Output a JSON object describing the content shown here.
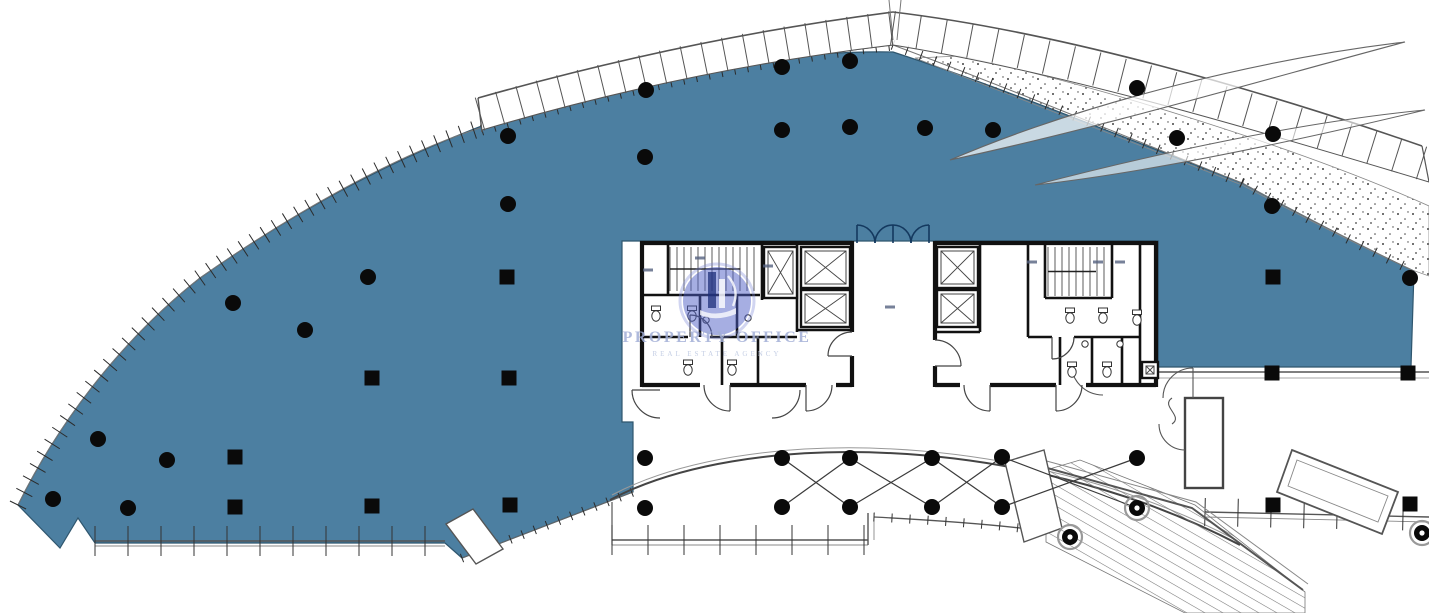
{
  "page": {
    "type": "architectural-floor-plan",
    "background": "#ffffff"
  },
  "watermark": {
    "title": "PROPERTY OFFICE",
    "subtitle": "REAL ESTATE AGENCY",
    "title_color": "#a2aed6",
    "subtitle_color": "#b6c2de",
    "emblem_color": "rgba(78,94,198,0.50)",
    "emblem_ring_color": "rgba(122,136,214,0.35)",
    "emblem_icon": "building-towers-icon"
  },
  "colors": {
    "floor": "#4C7FA1",
    "floor_edge": "#2f566e",
    "wall": "#111111",
    "line": "#555555",
    "tick": "#2b2b2b",
    "band_tick": "#555555",
    "door": "#444444",
    "entry_door": "#14395f",
    "column": "#0a0a0a",
    "stipple": "#444444"
  },
  "plan": {
    "columns": {
      "round": [
        [
          98,
          439
        ],
        [
          53,
          499
        ],
        [
          128,
          508
        ],
        [
          167,
          460
        ],
        [
          233,
          303
        ],
        [
          305,
          330
        ],
        [
          368,
          277
        ],
        [
          508,
          136
        ],
        [
          508,
          204
        ],
        [
          646,
          90
        ],
        [
          645,
          157
        ],
        [
          782,
          67
        ],
        [
          850,
          61
        ],
        [
          782,
          130
        ],
        [
          850,
          127
        ],
        [
          925,
          128
        ],
        [
          993,
          130
        ],
        [
          1137,
          88
        ],
        [
          1177,
          138
        ],
        [
          1273,
          134
        ],
        [
          1272,
          206
        ],
        [
          1410,
          278
        ],
        [
          645,
          458
        ],
        [
          645,
          508
        ],
        [
          782,
          458
        ],
        [
          782,
          507
        ],
        [
          850,
          458
        ],
        [
          850,
          507
        ],
        [
          932,
          458
        ],
        [
          932,
          507
        ],
        [
          1002,
          457
        ],
        [
          1002,
          507
        ],
        [
          1137,
          458
        ]
      ],
      "square": [
        [
          235,
          457
        ],
        [
          235,
          507
        ],
        [
          372,
          506
        ],
        [
          510,
          505
        ],
        [
          372,
          378
        ],
        [
          509,
          378
        ],
        [
          507,
          277
        ],
        [
          1273,
          277
        ],
        [
          1272,
          373
        ],
        [
          1408,
          373
        ],
        [
          1273,
          505
        ],
        [
          1410,
          504
        ]
      ],
      "ringed": [
        [
          1070,
          537
        ],
        [
          1137,
          508
        ],
        [
          1422,
          533
        ]
      ]
    },
    "bracing": [
      [
        782,
        458,
        850,
        507
      ],
      [
        850,
        458,
        782,
        507
      ],
      [
        850,
        458,
        932,
        507
      ],
      [
        932,
        458,
        850,
        507
      ],
      [
        932,
        458,
        1002,
        507
      ],
      [
        1002,
        457,
        932,
        507
      ],
      [
        1002,
        457,
        1137,
        508
      ],
      [
        1137,
        458,
        1002,
        507
      ]
    ],
    "elevators": [
      [
        764,
        247,
        33,
        51
      ],
      [
        801,
        247,
        49,
        41
      ],
      [
        801,
        290,
        49,
        37
      ],
      [
        937,
        247,
        41,
        41
      ],
      [
        937,
        290,
        41,
        37
      ],
      [
        1142,
        362,
        16,
        16
      ]
    ],
    "stairs": [
      {
        "x": 670,
        "y": 247,
        "w": 88,
        "h": 44,
        "step": 7
      },
      {
        "x": 1048,
        "y": 247,
        "w": 60,
        "h": 49,
        "step": 7
      }
    ],
    "fixtures": [
      [
        656,
        316
      ],
      [
        692,
        316
      ],
      [
        688,
        370
      ],
      [
        732,
        370
      ],
      [
        1070,
        318
      ],
      [
        1103,
        318
      ],
      [
        1072,
        372
      ],
      [
        1107,
        372
      ],
      [
        1137,
        320
      ]
    ],
    "sinks": [
      [
        706,
        320
      ],
      [
        748,
        318
      ],
      [
        1085,
        344
      ],
      [
        1120,
        344
      ]
    ],
    "label_marks": [
      [
        648,
        270
      ],
      [
        768,
        266
      ],
      [
        700,
        258
      ],
      [
        1032,
        262
      ],
      [
        1098,
        262
      ],
      [
        1120,
        262
      ],
      [
        890,
        307
      ]
    ]
  }
}
